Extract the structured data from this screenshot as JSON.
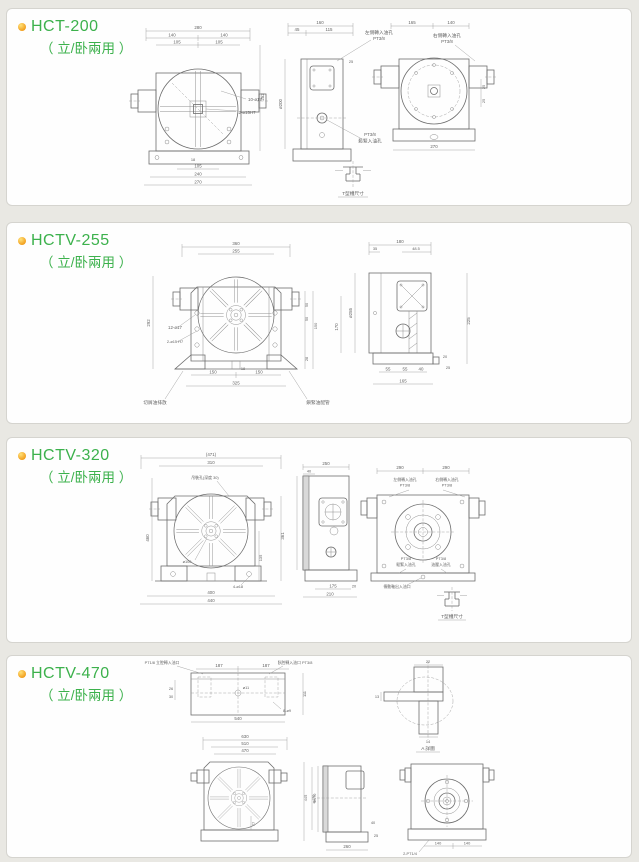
{
  "theme": {
    "accent_green": "#3cb14c",
    "bullet_orange": "#f2a01f",
    "line_gray": "#6d6d6d"
  },
  "panels": [
    {
      "title": "HCT-200",
      "subtitle": "（ 立/卧兩用 ）",
      "front": {
        "d280": "280",
        "d140a": "140",
        "d140b": "140",
        "d105a": "105",
        "d105b": "105",
        "d252": "252",
        "holes": "10-ø17",
        "pins": "2-ø15H7",
        "d18": "18",
        "b105": "105",
        "b240": "240",
        "b270": "270"
      },
      "side": {
        "d160": "160",
        "d45": "45",
        "d115": "115",
        "d25": "25",
        "dia": "ø200",
        "oil": "左側轉入油孔",
        "oil_t": "PT3/8",
        "clamp_t": "PT3/8",
        "clamp": "鬆緊入油孔",
        "tslot": "T型槽尺寸"
      },
      "rear": {
        "d165": "165",
        "d140": "140",
        "d270": "270",
        "d25a": "25",
        "d25b": "25",
        "oil": "右側轉入油孔",
        "oil_t": "PT3/8"
      }
    },
    {
      "title": "HCTV-255",
      "subtitle": "（ 立/卧兩用 ）",
      "front": {
        "d360": "360",
        "d255": "255",
        "d292": "292",
        "holes": "12-ø17",
        "pins": "2-ø15 H7",
        "r50a": "50",
        "r50b": "50",
        "r150": "150",
        "r28": "28",
        "d18": "18",
        "b150a": "150",
        "b150b": "150",
        "b325": "325",
        "drain": "切屑油排放",
        "clamp": "鎖緊油配管"
      },
      "side": {
        "d180": "180",
        "d35": "35",
        "d485": "48.5",
        "dia": "ø255",
        "d170": "170",
        "d225": "225",
        "b55a": "55",
        "b55b": "55",
        "b40": "40",
        "b165": "165",
        "d20": "20",
        "d25": "25"
      }
    },
    {
      "title": "HCTV-320",
      "subtitle": "（ 立/卧兩用 ）",
      "front": {
        "d471": "(471)",
        "d310": "310",
        "hoist": "吊裝孔(深度 30)",
        "d460": "460",
        "d361": "361",
        "d135": "135",
        "dia": "ø100",
        "bolt": "4-ø18",
        "b400": "400",
        "b440": "440"
      },
      "side": {
        "d250": "250",
        "d40": "40",
        "b175": "175",
        "b20": "20",
        "b210": "210"
      },
      "rear": {
        "d290a": "290",
        "d290b": "290",
        "oil_l": "左側轉入油孔",
        "oil_lt": "PT3/8",
        "oil_r": "右側轉入油孔",
        "oil_rt": "PT3/8",
        "clamp_t": "PT3/8",
        "clamp": "鬆緊入油孔",
        "hyd_t": "PT3/8",
        "hyd": "油壓入油孔",
        "drive": "傳動軸出入油口",
        "tslot": "T型槽尺寸"
      }
    },
    {
      "title": "HCTV-470",
      "subtitle": "（ 立/卧兩用 ）",
      "top": {
        "oil_l": "PT1/8 立腔轉入油口",
        "oil_r": "臥腔轉入油口 PT3/8",
        "d187a": "187",
        "d187b": "187",
        "d26": "26",
        "d30": "30",
        "d111": "111",
        "holes": "8-ø9",
        "d11": "ø11",
        "d540": "540"
      },
      "front": {
        "d630": "630",
        "d510": "510",
        "d470": "470",
        "d445": "445",
        "dia": "ø470",
        "d77": "77"
      },
      "detail": {
        "d22": "22",
        "d13": "13",
        "d14": "14",
        "label": "A 詳圖"
      },
      "side": {
        "dia": "ø470",
        "d40": "40",
        "d25": "25",
        "d260": "260"
      },
      "rear": {
        "d140a": "140",
        "d140b": "140",
        "pt": "2-PT1/4"
      }
    }
  ]
}
